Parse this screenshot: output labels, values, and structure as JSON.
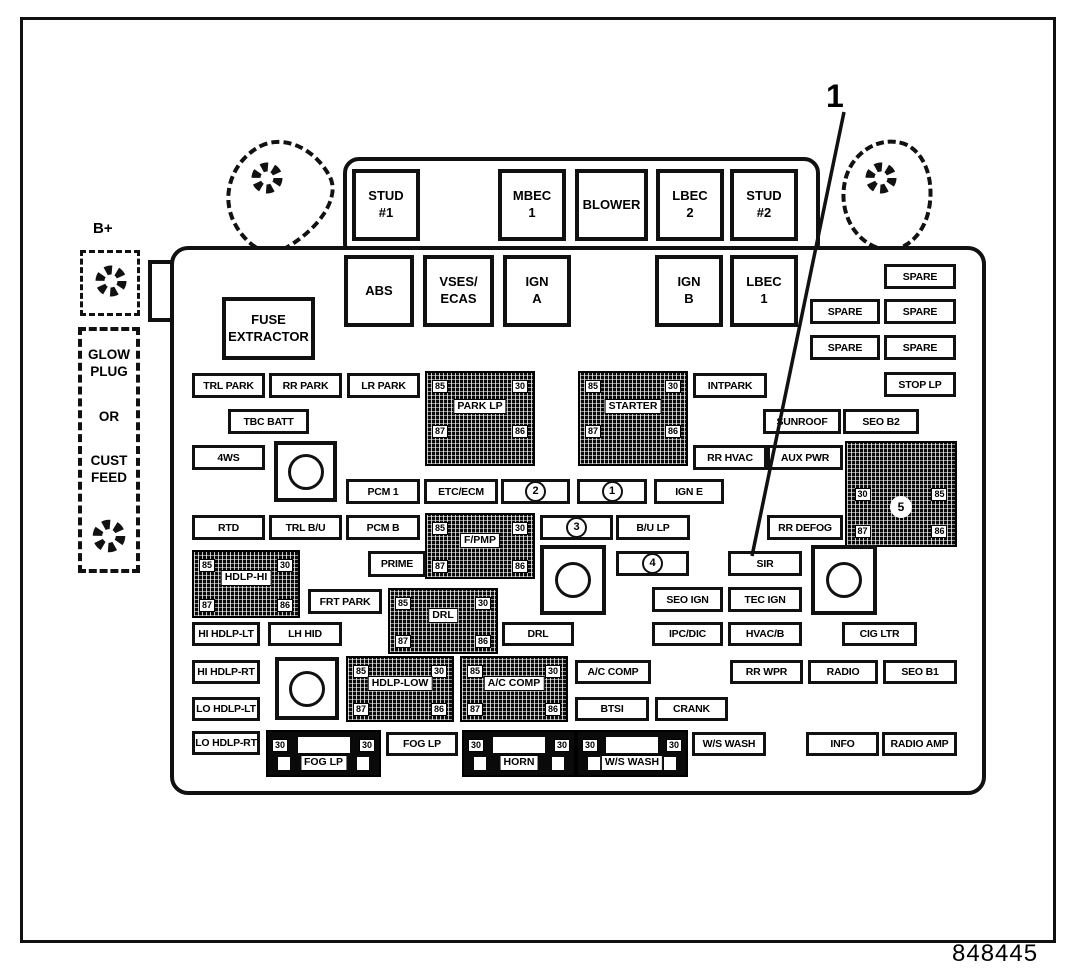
{
  "figure": {
    "number": "848445"
  },
  "callout": {
    "label": "1",
    "target": "SIR"
  },
  "side": {
    "b_plus_label": "B+",
    "glow_plug_label": "GLOW\nPLUG",
    "or_label": "OR",
    "cust_feed_label": "CUST\nFEED"
  },
  "icons": {
    "bolt": "mounting-bolt-icon"
  },
  "relay_pins": {
    "top_left": "85",
    "top_right": "30",
    "bottom_left": "87",
    "bottom_right": "86"
  },
  "items": [
    {
      "t": "big",
      "l": "STUD\n#1",
      "x": 352,
      "y": 169,
      "w": 68,
      "h": 72
    },
    {
      "t": "big",
      "l": "MBEC\n1",
      "x": 498,
      "y": 169,
      "w": 68,
      "h": 72
    },
    {
      "t": "big",
      "l": "BLOWER",
      "x": 575,
      "y": 169,
      "w": 73,
      "h": 72
    },
    {
      "t": "big",
      "l": "LBEC\n2",
      "x": 656,
      "y": 169,
      "w": 68,
      "h": 72
    },
    {
      "t": "big",
      "l": "STUD\n#2",
      "x": 730,
      "y": 169,
      "w": 68,
      "h": 72
    },
    {
      "t": "big",
      "l": "ABS",
      "x": 344,
      "y": 255,
      "w": 70,
      "h": 72
    },
    {
      "t": "big",
      "l": "VSES/\nECAS",
      "x": 423,
      "y": 255,
      "w": 71,
      "h": 72
    },
    {
      "t": "big",
      "l": "IGN\nA",
      "x": 503,
      "y": 255,
      "w": 68,
      "h": 72
    },
    {
      "t": "big",
      "l": "IGN\nB",
      "x": 655,
      "y": 255,
      "w": 68,
      "h": 72
    },
    {
      "t": "big",
      "l": "LBEC\n1",
      "x": 730,
      "y": 255,
      "w": 68,
      "h": 72
    },
    {
      "t": "big",
      "l": "FUSE\nEXTRACTOR",
      "x": 222,
      "y": 297,
      "w": 93,
      "h": 63
    },
    {
      "t": "fuse",
      "l": "SPARE",
      "x": 884,
      "y": 264,
      "w": 72,
      "h": 25
    },
    {
      "t": "fuse",
      "l": "SPARE",
      "x": 810,
      "y": 299,
      "w": 70,
      "h": 25
    },
    {
      "t": "fuse",
      "l": "SPARE",
      "x": 884,
      "y": 299,
      "w": 72,
      "h": 25
    },
    {
      "t": "fuse",
      "l": "SPARE",
      "x": 810,
      "y": 335,
      "w": 70,
      "h": 25
    },
    {
      "t": "fuse",
      "l": "SPARE",
      "x": 884,
      "y": 335,
      "w": 72,
      "h": 25
    },
    {
      "t": "fuse",
      "l": "STOP LP",
      "x": 884,
      "y": 372,
      "w": 72,
      "h": 25
    },
    {
      "t": "fuse",
      "l": "TRL PARK",
      "x": 192,
      "y": 373,
      "w": 73,
      "h": 25
    },
    {
      "t": "fuse",
      "l": "RR PARK",
      "x": 269,
      "y": 373,
      "w": 73,
      "h": 25
    },
    {
      "t": "fuse",
      "l": "LR PARK",
      "x": 347,
      "y": 373,
      "w": 73,
      "h": 25
    },
    {
      "t": "relay",
      "l": "PARK LP",
      "x": 425,
      "y": 371,
      "w": 110,
      "h": 95,
      "c": [
        "85",
        "30",
        "87",
        "86"
      ]
    },
    {
      "t": "relay",
      "l": "STARTER",
      "x": 578,
      "y": 371,
      "w": 110,
      "h": 95,
      "c": [
        "85",
        "30",
        "87",
        "86"
      ]
    },
    {
      "t": "fuse",
      "l": "INTPARK",
      "x": 693,
      "y": 373,
      "w": 74,
      "h": 25
    },
    {
      "t": "fuse",
      "l": "TBC BATT",
      "x": 228,
      "y": 409,
      "w": 81,
      "h": 25
    },
    {
      "t": "fuse",
      "l": "SUNROOF",
      "x": 763,
      "y": 409,
      "w": 78,
      "h": 25
    },
    {
      "t": "fuse",
      "l": "SEO B2",
      "x": 843,
      "y": 409,
      "w": 76,
      "h": 25
    },
    {
      "t": "fuse",
      "l": "4WS",
      "x": 192,
      "y": 445,
      "w": 73,
      "h": 25
    },
    {
      "t": "socket",
      "x": 274,
      "y": 441,
      "w": 63,
      "h": 61
    },
    {
      "t": "fuse",
      "l": "RR HVAC",
      "x": 693,
      "y": 445,
      "w": 74,
      "h": 25
    },
    {
      "t": "fuse",
      "l": "AUX PWR",
      "x": 767,
      "y": 445,
      "w": 76,
      "h": 25
    },
    {
      "t": "relay5",
      "l": "5",
      "x": 845,
      "y": 441,
      "w": 112,
      "h": 106,
      "c": [
        "30",
        "85",
        "87",
        "86"
      ]
    },
    {
      "t": "fuse",
      "l": "PCM 1",
      "x": 346,
      "y": 479,
      "w": 74,
      "h": 25
    },
    {
      "t": "fuse",
      "l": "ETC/ECM",
      "x": 424,
      "y": 479,
      "w": 74,
      "h": 25
    },
    {
      "t": "cfuse",
      "l": "2",
      "x": 501,
      "y": 479,
      "w": 69,
      "h": 25
    },
    {
      "t": "cfuse",
      "l": "1",
      "x": 577,
      "y": 479,
      "w": 70,
      "h": 25
    },
    {
      "t": "fuse",
      "l": "IGN E",
      "x": 654,
      "y": 479,
      "w": 70,
      "h": 25
    },
    {
      "t": "fuse",
      "l": "RTD",
      "x": 192,
      "y": 515,
      "w": 73,
      "h": 25
    },
    {
      "t": "fuse",
      "l": "TRL B/U",
      "x": 269,
      "y": 515,
      "w": 73,
      "h": 25
    },
    {
      "t": "fuse",
      "l": "PCM B",
      "x": 346,
      "y": 515,
      "w": 74,
      "h": 25
    },
    {
      "t": "relay",
      "l": "F/PMP",
      "x": 425,
      "y": 513,
      "w": 110,
      "h": 66,
      "c": [
        "85",
        "30",
        "87",
        "86"
      ]
    },
    {
      "t": "cfuse",
      "l": "3",
      "x": 540,
      "y": 515,
      "w": 73,
      "h": 25
    },
    {
      "t": "fuse",
      "l": "B/U LP",
      "x": 616,
      "y": 515,
      "w": 74,
      "h": 25
    },
    {
      "t": "fuse",
      "l": "RR DEFOG",
      "x": 767,
      "y": 515,
      "w": 76,
      "h": 25
    },
    {
      "t": "fuse",
      "l": "PRIME",
      "x": 368,
      "y": 551,
      "w": 58,
      "h": 26
    },
    {
      "t": "socket",
      "x": 540,
      "y": 545,
      "w": 66,
      "h": 70
    },
    {
      "t": "cfuse",
      "l": "4",
      "x": 616,
      "y": 551,
      "w": 73,
      "h": 25
    },
    {
      "t": "fuse",
      "l": "SIR",
      "x": 728,
      "y": 551,
      "w": 74,
      "h": 25
    },
    {
      "t": "socket",
      "x": 811,
      "y": 545,
      "w": 66,
      "h": 70
    },
    {
      "t": "relay",
      "l": "HDLP-HI",
      "x": 192,
      "y": 550,
      "w": 108,
      "h": 68,
      "c": [
        "85",
        "30",
        "87",
        "86"
      ]
    },
    {
      "t": "fuse",
      "l": "FRT PARK",
      "x": 308,
      "y": 589,
      "w": 74,
      "h": 25
    },
    {
      "t": "relay",
      "l": "DRL",
      "x": 388,
      "y": 588,
      "w": 110,
      "h": 66,
      "c": [
        "85",
        "30",
        "87",
        "86"
      ]
    },
    {
      "t": "fuse",
      "l": "SEO IGN",
      "x": 652,
      "y": 587,
      "w": 71,
      "h": 25
    },
    {
      "t": "fuse",
      "l": "TEC IGN",
      "x": 728,
      "y": 587,
      "w": 74,
      "h": 25
    },
    {
      "t": "fuse",
      "l": "HI HDLP-LT",
      "x": 192,
      "y": 622,
      "w": 68,
      "h": 24
    },
    {
      "t": "fuse",
      "l": "LH HID",
      "x": 268,
      "y": 622,
      "w": 74,
      "h": 24
    },
    {
      "t": "fuse",
      "l": "DRL",
      "x": 502,
      "y": 622,
      "w": 72,
      "h": 24
    },
    {
      "t": "fuse",
      "l": "IPC/DIC",
      "x": 652,
      "y": 622,
      "w": 71,
      "h": 24
    },
    {
      "t": "fuse",
      "l": "HVAC/B",
      "x": 728,
      "y": 622,
      "w": 74,
      "h": 24
    },
    {
      "t": "fuse",
      "l": "CIG LTR",
      "x": 842,
      "y": 622,
      "w": 75,
      "h": 24
    },
    {
      "t": "fuse",
      "l": "HI HDLP-RT",
      "x": 192,
      "y": 660,
      "w": 68,
      "h": 24
    },
    {
      "t": "socket",
      "x": 275,
      "y": 657,
      "w": 64,
      "h": 63
    },
    {
      "t": "relay",
      "l": "HDLP-LOW",
      "x": 346,
      "y": 656,
      "w": 108,
      "h": 66,
      "c": [
        "85",
        "30",
        "87",
        "86"
      ]
    },
    {
      "t": "relay",
      "l": "A/C COMP",
      "x": 460,
      "y": 656,
      "w": 108,
      "h": 66,
      "c": [
        "85",
        "30",
        "87",
        "86"
      ]
    },
    {
      "t": "fuse",
      "l": "A/C COMP",
      "x": 575,
      "y": 660,
      "w": 76,
      "h": 24
    },
    {
      "t": "fuse",
      "l": "RR WPR",
      "x": 730,
      "y": 660,
      "w": 73,
      "h": 24
    },
    {
      "t": "fuse",
      "l": "RADIO",
      "x": 808,
      "y": 660,
      "w": 70,
      "h": 24
    },
    {
      "t": "fuse",
      "l": "SEO B1",
      "x": 883,
      "y": 660,
      "w": 74,
      "h": 24
    },
    {
      "t": "fuse",
      "l": "LO HDLP-LT",
      "x": 192,
      "y": 697,
      "w": 68,
      "h": 24
    },
    {
      "t": "fuse",
      "l": "BTSI",
      "x": 575,
      "y": 697,
      "w": 74,
      "h": 24
    },
    {
      "t": "fuse",
      "l": "CRANK",
      "x": 655,
      "y": 697,
      "w": 73,
      "h": 24
    },
    {
      "t": "fuse",
      "l": "LO HDLP-RT",
      "x": 192,
      "y": 731,
      "w": 68,
      "h": 24
    },
    {
      "t": "maxi",
      "l": "FOG LP",
      "x": 266,
      "y": 730,
      "w": 115,
      "h": 47,
      "p": [
        "30",
        "30"
      ]
    },
    {
      "t": "fuse",
      "l": "FOG LP",
      "x": 386,
      "y": 732,
      "w": 72,
      "h": 24
    },
    {
      "t": "maxi",
      "l": "HORN",
      "x": 462,
      "y": 730,
      "w": 114,
      "h": 47,
      "p": [
        "30",
        "30"
      ]
    },
    {
      "t": "maxi",
      "l": "W/S WASH",
      "x": 576,
      "y": 730,
      "w": 112,
      "h": 47,
      "p": [
        "30",
        "30"
      ]
    },
    {
      "t": "fuse",
      "l": "W/S WASH",
      "x": 692,
      "y": 732,
      "w": 74,
      "h": 24
    },
    {
      "t": "fuse",
      "l": "INFO",
      "x": 806,
      "y": 732,
      "w": 73,
      "h": 24
    },
    {
      "t": "fuse",
      "l": "RADIO AMP",
      "x": 882,
      "y": 732,
      "w": 75,
      "h": 24
    }
  ]
}
